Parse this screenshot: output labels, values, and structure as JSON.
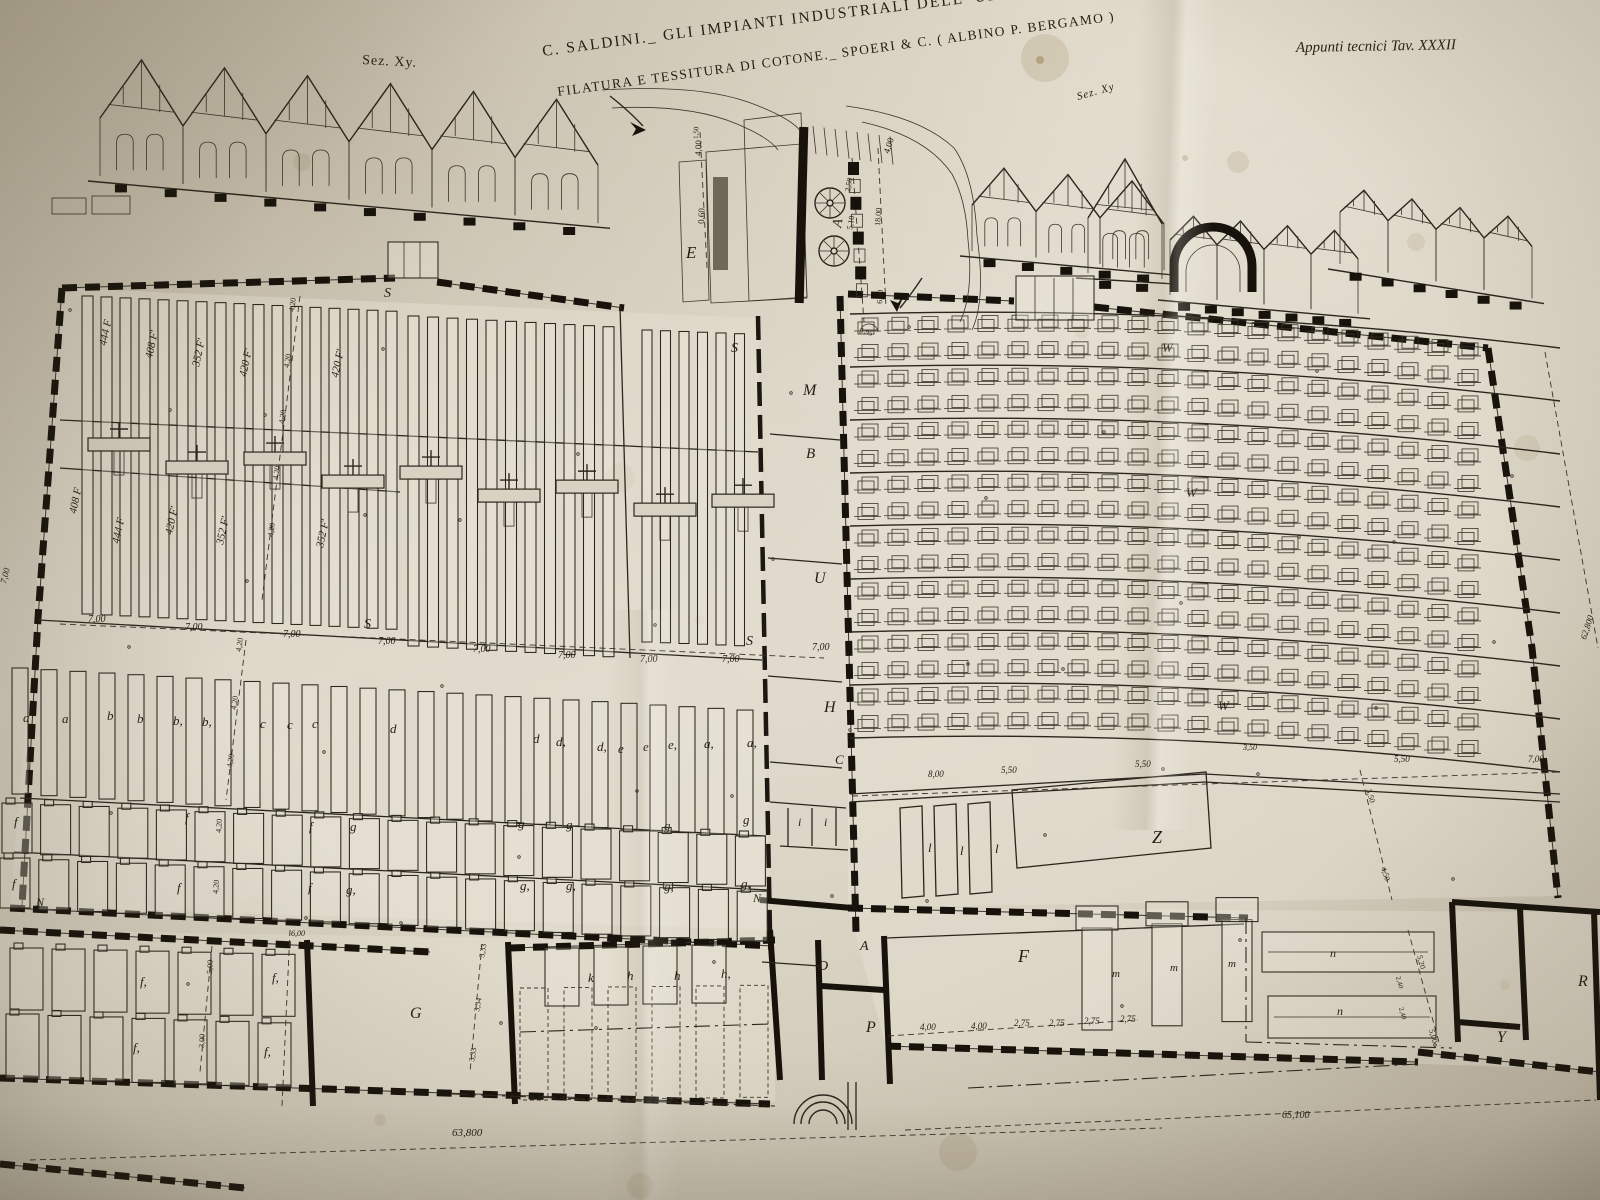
{
  "header": {
    "title_line1": "C. SALDINI._ GLI IMPIANTI INDUSTRIALI DELL' ULTIMO VENTENNIO",
    "title_line2": "FILATURA E TESSITURA DI COTONE._ SPOERI & C. ( ALBINO P. BERGAMO )",
    "plate_ref": "Appunti tecnici  Tav. XXXII",
    "section_label_left": "Sez. Xy.",
    "section_label_right": "Sez. Xy"
  },
  "colors": {
    "paper": "#d3ccbb",
    "ink": "#261f14",
    "stain": "#7c602e"
  },
  "labels": [
    [
      "E",
      686,
      258,
      0,
      17,
      1
    ],
    [
      "A",
      841,
      228,
      -80,
      14,
      1
    ],
    [
      "4,00",
      701,
      156,
      -88,
      9,
      0
    ],
    [
      "1,50",
      698,
      139,
      -88,
      7,
      0
    ],
    [
      "0,60",
      704,
      224,
      -88,
      9,
      0
    ],
    [
      "4,00",
      889,
      154,
      -72,
      9,
      0
    ],
    [
      "2,50",
      850,
      192,
      -80,
      8,
      0
    ],
    [
      "5,10",
      852,
      230,
      -80,
      8,
      0
    ],
    [
      "18,00",
      880,
      226,
      -86,
      8,
      0
    ],
    [
      "6,00",
      882,
      304,
      -86,
      8,
      0
    ],
    [
      "1,95",
      860,
      332,
      18,
      7,
      0
    ],
    [
      "444 F",
      106,
      346,
      -78,
      11,
      1
    ],
    [
      "408 F'",
      152,
      359,
      -78,
      11,
      1
    ],
    [
      "352 F'",
      199,
      367,
      -78,
      11,
      1
    ],
    [
      "420 F'",
      246,
      377,
      -78,
      11,
      1
    ],
    [
      "420 F'",
      338,
      378,
      -78,
      11,
      1
    ],
    [
      "4,20",
      294,
      312,
      -82,
      8,
      0
    ],
    [
      "4,20",
      289,
      368,
      -82,
      8,
      0
    ],
    [
      "4,20",
      284,
      424,
      -82,
      8,
      0
    ],
    [
      "4,20",
      278,
      480,
      -82,
      8,
      0
    ],
    [
      "4,20",
      273,
      537,
      -82,
      8,
      0
    ],
    [
      "408 F",
      76,
      514,
      -78,
      11,
      1
    ],
    [
      "444 F",
      119,
      544,
      -78,
      11,
      1
    ],
    [
      "420 F'",
      172,
      535,
      -78,
      11,
      1
    ],
    [
      "352 F'",
      223,
      545,
      -78,
      11,
      1
    ],
    [
      "352 F'",
      323,
      548,
      -78,
      11,
      1
    ],
    [
      "4,20",
      241,
      652,
      -82,
      8,
      0
    ],
    [
      "4,20",
      236,
      710,
      -82,
      8,
      0
    ],
    [
      "4,20",
      232,
      768,
      -82,
      8,
      0
    ],
    [
      "S",
      384,
      297,
      0,
      14,
      1
    ],
    [
      "S",
      731,
      352,
      0,
      14,
      1
    ],
    [
      "S",
      364,
      628,
      0,
      14,
      1
    ],
    [
      "S",
      746,
      645,
      0,
      14,
      1
    ],
    [
      "7,00",
      88,
      622,
      0,
      10,
      1
    ],
    [
      "7,00",
      185,
      630,
      0,
      10,
      1
    ],
    [
      "7,00",
      283,
      637,
      0,
      10,
      1
    ],
    [
      "7,00",
      378,
      644,
      0,
      10,
      1
    ],
    [
      "7,00",
      473,
      652,
      0,
      10,
      1
    ],
    [
      "7,00",
      558,
      658,
      0,
      10,
      1
    ],
    [
      "7,00",
      640,
      662,
      0,
      10,
      1
    ],
    [
      "7,00",
      722,
      662,
      0,
      10,
      1
    ],
    [
      "7,00",
      6,
      584,
      -76,
      9,
      1
    ],
    [
      "a",
      23,
      722,
      0,
      13,
      1
    ],
    [
      "a",
      62,
      723,
      0,
      13,
      1
    ],
    [
      "b",
      107,
      720,
      0,
      13,
      1
    ],
    [
      "b",
      137,
      723,
      0,
      13,
      1
    ],
    [
      "b,",
      173,
      725,
      0,
      13,
      1
    ],
    [
      "b,",
      202,
      726,
      0,
      13,
      1
    ],
    [
      "c",
      260,
      728,
      0,
      13,
      1
    ],
    [
      "c",
      287,
      729,
      0,
      13,
      1
    ],
    [
      "c",
      312,
      728,
      0,
      13,
      1
    ],
    [
      "d",
      390,
      733,
      0,
      13,
      1
    ],
    [
      "d",
      533,
      743,
      0,
      13,
      1
    ],
    [
      "d,",
      556,
      746,
      0,
      13,
      1
    ],
    [
      "d,",
      597,
      751,
      0,
      13,
      1
    ],
    [
      "e",
      618,
      753,
      0,
      13,
      1
    ],
    [
      "e",
      643,
      751,
      0,
      13,
      1
    ],
    [
      "e,",
      668,
      749,
      0,
      13,
      1
    ],
    [
      "a,",
      704,
      748,
      0,
      13,
      1
    ],
    [
      "a,",
      747,
      747,
      0,
      13,
      1
    ],
    [
      "f",
      14,
      826,
      0,
      13,
      1
    ],
    [
      "f",
      185,
      822,
      0,
      13,
      1
    ],
    [
      "f",
      309,
      831,
      0,
      13,
      1
    ],
    [
      "g",
      350,
      831,
      0,
      13,
      1
    ],
    [
      "g",
      518,
      828,
      0,
      13,
      1
    ],
    [
      "g",
      566,
      829,
      0,
      13,
      1
    ],
    [
      "g",
      664,
      830,
      0,
      13,
      1
    ],
    [
      "g",
      743,
      824,
      0,
      13,
      1
    ],
    [
      "i",
      798,
      826,
      0,
      12,
      1
    ],
    [
      "i",
      824,
      826,
      0,
      12,
      1
    ],
    [
      "f",
      12,
      888,
      0,
      13,
      1
    ],
    [
      "f",
      177,
      892,
      0,
      13,
      1
    ],
    [
      "f",
      308,
      892,
      0,
      13,
      1
    ],
    [
      "g,",
      346,
      894,
      0,
      13,
      1
    ],
    [
      "g,",
      520,
      890,
      0,
      13,
      1
    ],
    [
      "g,",
      566,
      890,
      0,
      13,
      1
    ],
    [
      "g,",
      664,
      891,
      0,
      13,
      1
    ],
    [
      "g,",
      741,
      888,
      0,
      13,
      1
    ],
    [
      "4,20",
      221,
      833,
      -86,
      8,
      0
    ],
    [
      "4,20",
      218,
      894,
      -86,
      8,
      0
    ],
    [
      "N",
      36,
      906,
      0,
      12,
      1
    ],
    [
      "N",
      753,
      902,
      0,
      12,
      1
    ],
    [
      "M",
      803,
      395,
      0,
      16,
      1
    ],
    [
      "B",
      806,
      458,
      0,
      15,
      1
    ],
    [
      "U",
      814,
      583,
      0,
      16,
      1
    ],
    [
      "7,00",
      812,
      650,
      0,
      10,
      1
    ],
    [
      "H",
      824,
      712,
      0,
      16,
      1
    ],
    [
      "C",
      835,
      764,
      0,
      13,
      1
    ],
    [
      "W",
      1162,
      352,
      0,
      13,
      1
    ],
    [
      "W",
      1186,
      497,
      0,
      13,
      1
    ],
    [
      "W",
      1218,
      710,
      0,
      13,
      1
    ],
    [
      "8,00",
      928,
      777,
      0,
      9,
      1
    ],
    [
      "5,50",
      1001,
      773,
      0,
      9,
      1
    ],
    [
      "5,50",
      1135,
      767,
      0,
      9,
      1
    ],
    [
      "3,50",
      1243,
      750,
      0,
      8,
      1
    ],
    [
      "5,50",
      1394,
      762,
      0,
      9,
      1
    ],
    [
      "7,00",
      1528,
      762,
      0,
      9,
      1
    ],
    [
      "3,50",
      1366,
      790,
      72,
      8,
      0
    ],
    [
      "4,50",
      1381,
      868,
      72,
      8,
      0
    ],
    [
      "5,20",
      1417,
      956,
      75,
      8,
      0
    ],
    [
      "2,40",
      1396,
      977,
      75,
      7,
      0
    ],
    [
      "2,40",
      1399,
      1008,
      75,
      7,
      0
    ],
    [
      "5,00",
      1429,
      1030,
      75,
      8,
      0
    ],
    [
      "62,800",
      1586,
      640,
      -72,
      9,
      1
    ],
    [
      "l",
      928,
      852,
      0,
      13,
      1
    ],
    [
      "l",
      960,
      855,
      0,
      13,
      1
    ],
    [
      "l",
      995,
      853,
      0,
      13,
      1
    ],
    [
      "Z",
      1152,
      843,
      0,
      18,
      1
    ],
    [
      "6,00",
      291,
      936,
      0,
      8,
      1
    ],
    [
      "f,",
      140,
      986,
      0,
      13,
      1
    ],
    [
      "f,",
      272,
      982,
      0,
      13,
      1
    ],
    [
      "f,",
      133,
      1052,
      0,
      13,
      1
    ],
    [
      "f,",
      264,
      1056,
      0,
      13,
      1
    ],
    [
      "5,00",
      212,
      974,
      -87,
      8,
      0
    ],
    [
      "3,00",
      204,
      1048,
      -87,
      8,
      0
    ],
    [
      "G",
      410,
      1018,
      0,
      16,
      1
    ],
    [
      "3,33",
      484,
      958,
      -80,
      8,
      0
    ],
    [
      "3,34",
      479,
      1012,
      -80,
      8,
      0
    ],
    [
      "3,33",
      474,
      1062,
      -80,
      8,
      0
    ],
    [
      "k",
      588,
      982,
      0,
      13,
      1
    ],
    [
      "h",
      627,
      980,
      0,
      13,
      1
    ],
    [
      "h",
      674,
      980,
      0,
      13,
      1
    ],
    [
      "h,",
      721,
      978,
      0,
      13,
      1
    ],
    [
      "A",
      860,
      950,
      0,
      14,
      1
    ],
    [
      "D",
      818,
      970,
      0,
      14,
      1
    ],
    [
      "P",
      866,
      1032,
      0,
      16,
      1
    ],
    [
      "F",
      1018,
      962,
      0,
      18,
      1
    ],
    [
      "m",
      1112,
      977,
      0,
      11,
      1
    ],
    [
      "m",
      1170,
      971,
      0,
      11,
      1
    ],
    [
      "m",
      1228,
      967,
      0,
      11,
      1
    ],
    [
      "4,00",
      920,
      1030,
      0,
      9,
      1
    ],
    [
      "4,00",
      971,
      1029,
      0,
      9,
      1
    ],
    [
      "2,75",
      1014,
      1026,
      0,
      9,
      1
    ],
    [
      "2,75",
      1049,
      1026,
      0,
      9,
      1
    ],
    [
      "2,75",
      1084,
      1024,
      0,
      9,
      1
    ],
    [
      "2,75",
      1120,
      1022,
      0,
      9,
      1
    ],
    [
      "n",
      1330,
      957,
      0,
      12,
      1
    ],
    [
      "n",
      1337,
      1015,
      0,
      12,
      1
    ],
    [
      "R",
      1578,
      986,
      0,
      16,
      1
    ],
    [
      "Y",
      1497,
      1042,
      0,
      16,
      1
    ],
    [
      "63,800",
      452,
      1136,
      0,
      11,
      1
    ],
    [
      "65,100",
      1282,
      1118,
      0,
      10,
      1
    ]
  ],
  "drawing": {
    "fills": [
      "M62,288 L758,318 L770,930 L10,906 Z",
      "M848,296 L1488,348 L1532,648 L1558,896 L848,908 Z",
      "M0,930 L775,942 L775,1102 L0,1080 Z",
      "M848,908 L1600,912 L1600,1070 L886,1046 Z"
    ],
    "roof_sections": [
      {
        "name": "section-left",
        "x0": 100,
        "y0": 118,
        "n": 6,
        "w": 83,
        "peak": 62,
        "slope": 0.095,
        "wallH": 58,
        "windows": 2,
        "found": 10
      },
      {
        "name": "section-right-a",
        "x0": 972,
        "y0": 205,
        "n": 3,
        "w": 64,
        "peak": 40,
        "slope": 0.1,
        "wallH": 46,
        "windows": 2,
        "found": 5
      },
      {
        "name": "section-right-tall",
        "x0": 1088,
        "y0": 218,
        "n": 1,
        "w": 74,
        "peak": 62,
        "slope": 0.08,
        "wallH": 55,
        "windows": 2,
        "found": 2
      },
      {
        "name": "section-right-saw1",
        "x0": 1170,
        "y0": 240,
        "n": 4,
        "w": 47,
        "peak": 26,
        "slope": 0.1,
        "wallH": 55,
        "windows": 0,
        "found": 7
      },
      {
        "name": "section-right-saw2",
        "x0": 1340,
        "y0": 212,
        "n": 4,
        "w": 48,
        "peak": 26,
        "slope": 0.18,
        "wallH": 52,
        "windows": 0,
        "found": 6
      }
    ],
    "walls": [
      {
        "d": "M62,288 L395,278 M437,282 L624,308 M62,288 L38,618 L22,906",
        "c": "wallP",
        "u": 1,
        "n": "spinning-shed-outer-wall"
      },
      {
        "d": "M10,908 L772,946",
        "c": "wallP",
        "u": 1,
        "n": "north-wall"
      },
      {
        "d": "M0,930 L430,952 M510,948 L775,940",
        "c": "wallP",
        "u": 1,
        "n": "bottom-band-top-wall"
      },
      {
        "d": "M0,1078 L770,1104 M0,1164 L245,1188",
        "c": "wallP",
        "u": 1,
        "n": "bottom-band-south-wall"
      },
      {
        "d": "M840,296 L856,932",
        "c": "wallP",
        "u": 1,
        "n": "corridor-east-wall"
      },
      {
        "d": "M848,294 L1014,301 M1094,307 L1488,348 M1488,348 L1532,648 L1558,898",
        "c": "wallP",
        "u": 1,
        "n": "weaving-shed-outer-wall"
      },
      {
        "d": "M848,908 L1248,918 M886,1046 L1418,1062 M1418,1052 L1600,1072",
        "c": "wallP",
        "u": 1,
        "n": "south-east-walls"
      },
      {
        "d": "M758,316 L770,932",
        "c": "wallG",
        "n": "corridor-west-wall"
      },
      {
        "d": "M307,940 L313,1106 M508,942 L515,1104 M770,930 L780,1080",
        "c": "wallB",
        "n": "room-divider-walls"
      },
      {
        "d": "M818,940 L822,1080 M884,936 L890,1084 M760,900 L852,908 M822,986 L884,990",
        "c": "wallB",
        "n": "entrance-room-walls"
      },
      {
        "d": "M1452,902 L1600,912 M1452,902 L1458,1042 M1520,908 L1526,1040 M1458,1022 L1520,1027 M1594,912 L1600,1100",
        "c": "wallB",
        "n": "office-room-walls"
      },
      {
        "d": "M770,434 L840,440 M768,558 L842,564 M768,676 L842,682 M770,762 L842,768 M770,802 L846,808 M788,808 L788,846 M812,808 L812,846 M836,808 L836,846 M780,846 L848,850 M762,962 L820,966 M38,620 L762,660 M20,798 L766,836 M14,852 L768,890 M60,420 L758,452 M60,468 L400,492 M620,306 L630,658 M850,794 L1205,774 L1560,794 M850,802 L1205,782 L1560,802 M1012,790 L1206,772 L1211,848 L1017,868 Z M900,808 L922,806 L924,896 L902,898 Z M934,806 L956,804 L958,894 L936,896 Z M968,804 L990,802 L992,892 L970,894 Z M886,938 L1244,924 M848,1082 L848,1130 M856,1082 L856,1130",
        "c": "wallT",
        "n": "interior-partition-lines"
      }
    ],
    "slat_bands": [
      {
        "x0": 82,
        "y": 296,
        "n": 17,
        "pitch": 19,
        "w": 11,
        "h": 318,
        "slope": 0.05
      },
      {
        "x0": 408,
        "y": 316,
        "n": 11,
        "pitch": 19.5,
        "w": 11,
        "h": 330,
        "slope": 0.055
      },
      {
        "x0": 642,
        "y": 330,
        "n": 6,
        "pitch": 18.5,
        "w": 10,
        "h": 312,
        "slope": 0.04
      },
      {
        "x0": 12,
        "y": 668,
        "n": 26,
        "pitch": 29,
        "w": 16,
        "h": 126,
        "slope": 0.058
      }
    ],
    "t_brackets": {
      "x0": 88,
      "y": 438,
      "n": 9,
      "pitch": 78,
      "w": 62,
      "h": 13,
      "slope": 0.09
    },
    "machine_rows": [
      {
        "x0": 2,
        "y": 803,
        "n": 20,
        "pitch": 38.6,
        "w": 30,
        "h": 50,
        "slope": 0.045,
        "knob": 1
      },
      {
        "x0": 0,
        "y": 858,
        "n": 20,
        "pitch": 38.8,
        "w": 30,
        "h": 50,
        "slope": 0.045,
        "knob": 1
      },
      {
        "x0": 10,
        "y": 948,
        "n": 7,
        "pitch": 42,
        "w": 33,
        "h": 62,
        "slope": 0.025,
        "knob": 1
      },
      {
        "x0": 6,
        "y": 1014,
        "n": 7,
        "pitch": 42,
        "w": 33,
        "h": 64,
        "slope": 0.035,
        "knob": 1
      },
      {
        "x0": 545,
        "y": 948,
        "n": 4,
        "pitch": 49,
        "w": 34,
        "h": 58,
        "slope": -0.02
      },
      {
        "x0": 520,
        "y": 988,
        "n": 6,
        "pitch": 44,
        "w": 28,
        "h": 112,
        "slope": -0.012,
        "dash": 1
      },
      {
        "x0": 1082,
        "y": 928,
        "n": 3,
        "pitch": 70,
        "w": 30,
        "h": 102,
        "slope": -0.06,
        "cap": 1
      },
      {
        "x0": 1262,
        "y": 932,
        "n": 1,
        "pitch": 0,
        "w": 172,
        "h": 40,
        "slope": 0,
        "inner": 1
      },
      {
        "x0": 1268,
        "y": 996,
        "n": 1,
        "pitch": 0,
        "w": 168,
        "h": 42,
        "slope": 0,
        "inner": 1
      }
    ],
    "loom_grid": {
      "x0": 858,
      "y0": 322,
      "cols": 21,
      "colPitch": 30,
      "rows": 16,
      "rowPitch": 26.5,
      "w": 16,
      "h": 12,
      "curve": -14,
      "slope": 0.045
    },
    "dim_lines": [
      [
        "M60,624 L824,658",
        "dim"
      ],
      [
        "M300,296 L262,600",
        "dim"
      ],
      [
        "M246,640 L226,800",
        "dim"
      ],
      [
        "M852,796 L1560,772",
        "dim"
      ],
      [
        "M888,1036 L1138,1020",
        "dim"
      ],
      [
        "M30,1160 L1162,1128",
        "dim"
      ],
      [
        "M905,1130 L1596,1100",
        "dim"
      ],
      [
        "M1545,352 L1598,648",
        "dim"
      ],
      [
        "M700,132 L707,268",
        "dim"
      ],
      [
        "M852,158 L864,322",
        "dim"
      ],
      [
        "M878,148 L886,308",
        "dim"
      ],
      [
        "M290,930 L282,1106",
        "dim"
      ],
      [
        "M482,944 L470,1072",
        "dim"
      ],
      [
        "M212,946 L200,1072",
        "dim"
      ],
      [
        "M1408,930 L1440,1046",
        "dim"
      ],
      [
        "M1360,770 L1392,900",
        "dim"
      ],
      [
        "M452,1094 L775,1106",
        "dimdd"
      ],
      [
        "M968,1088 L1418,1064",
        "dimdd"
      ],
      [
        "M1246,918 L1246,1042",
        "dimdd"
      ],
      [
        "M1246,1042 L1452,1048",
        "dimdd"
      ],
      [
        "M520,1032 L770,1024",
        "dimdd"
      ]
    ],
    "stains": [
      [
        1045,
        58,
        24,
        0.14
      ],
      [
        1238,
        162,
        11,
        0.12
      ],
      [
        620,
        478,
        15,
        0.1
      ],
      [
        302,
        162,
        9,
        0.1
      ],
      [
        1527,
        448,
        13,
        0.1
      ],
      [
        958,
        1152,
        19,
        0.12
      ],
      [
        640,
        1186,
        13,
        0.1
      ],
      [
        1082,
        332,
        7,
        0.12
      ],
      [
        252,
        908,
        11,
        0.08
      ],
      [
        1416,
        242,
        9,
        0.1
      ],
      [
        1040,
        60,
        4,
        0.35
      ],
      [
        1185,
        158,
        3,
        0.3
      ],
      [
        700,
        620,
        5,
        0.15
      ],
      [
        380,
        1120,
        6,
        0.12
      ],
      [
        1505,
        985,
        5,
        0.2
      ]
    ]
  }
}
